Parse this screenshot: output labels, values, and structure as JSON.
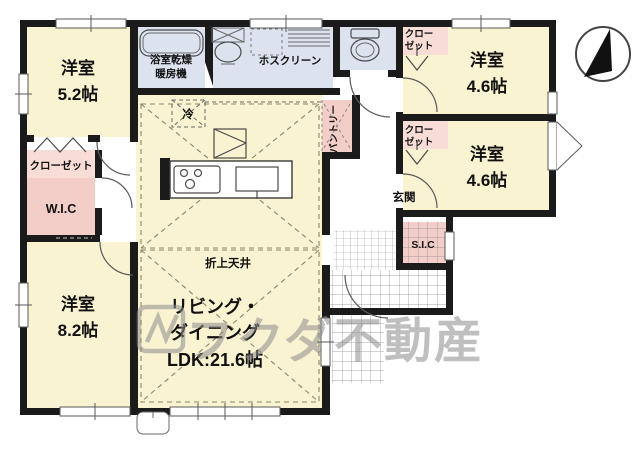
{
  "rooms": {
    "bedroom52": {
      "label": "洋室",
      "size": "5.2帖"
    },
    "bedroom82": {
      "label": "洋室",
      "size": "8.2帖"
    },
    "bedroom46a": {
      "label": "洋室",
      "size": "4.6帖"
    },
    "bedroom46b": {
      "label": "洋室",
      "size": "4.6帖"
    },
    "ldk": {
      "line1": "リビング・",
      "line2": "ダイニング",
      "line3": "LDK:21.6帖"
    },
    "bath": {
      "line1": "浴室乾燥",
      "line2": "暖房機"
    },
    "laundry": {
      "label": "ホスクリーン"
    },
    "closet_left": {
      "label": "クローゼット"
    },
    "wic": {
      "label": "W.I.C"
    },
    "closet_a": {
      "line1": "クロー",
      "line2": "ゼット"
    },
    "closet_b": {
      "line1": "クロー",
      "line2": "ゼット"
    },
    "pantry": {
      "label": "パントリー"
    },
    "entrance": {
      "label": "玄関"
    },
    "sic": {
      "label": "S.I.C"
    },
    "fridge": {
      "label": "冷"
    },
    "ceiling": {
      "label": "折上天井"
    }
  },
  "watermark": {
    "text": "フクダ不動産"
  },
  "colors": {
    "room_cream": "#FAF3D2",
    "closet_pink": "#F3CDC7",
    "closet_pink_light": "#F8DCD6",
    "wet_blue": "#DCE3EF",
    "wall_black": "#1B1B1B",
    "watermark_gray": "#8C8C8C"
  }
}
